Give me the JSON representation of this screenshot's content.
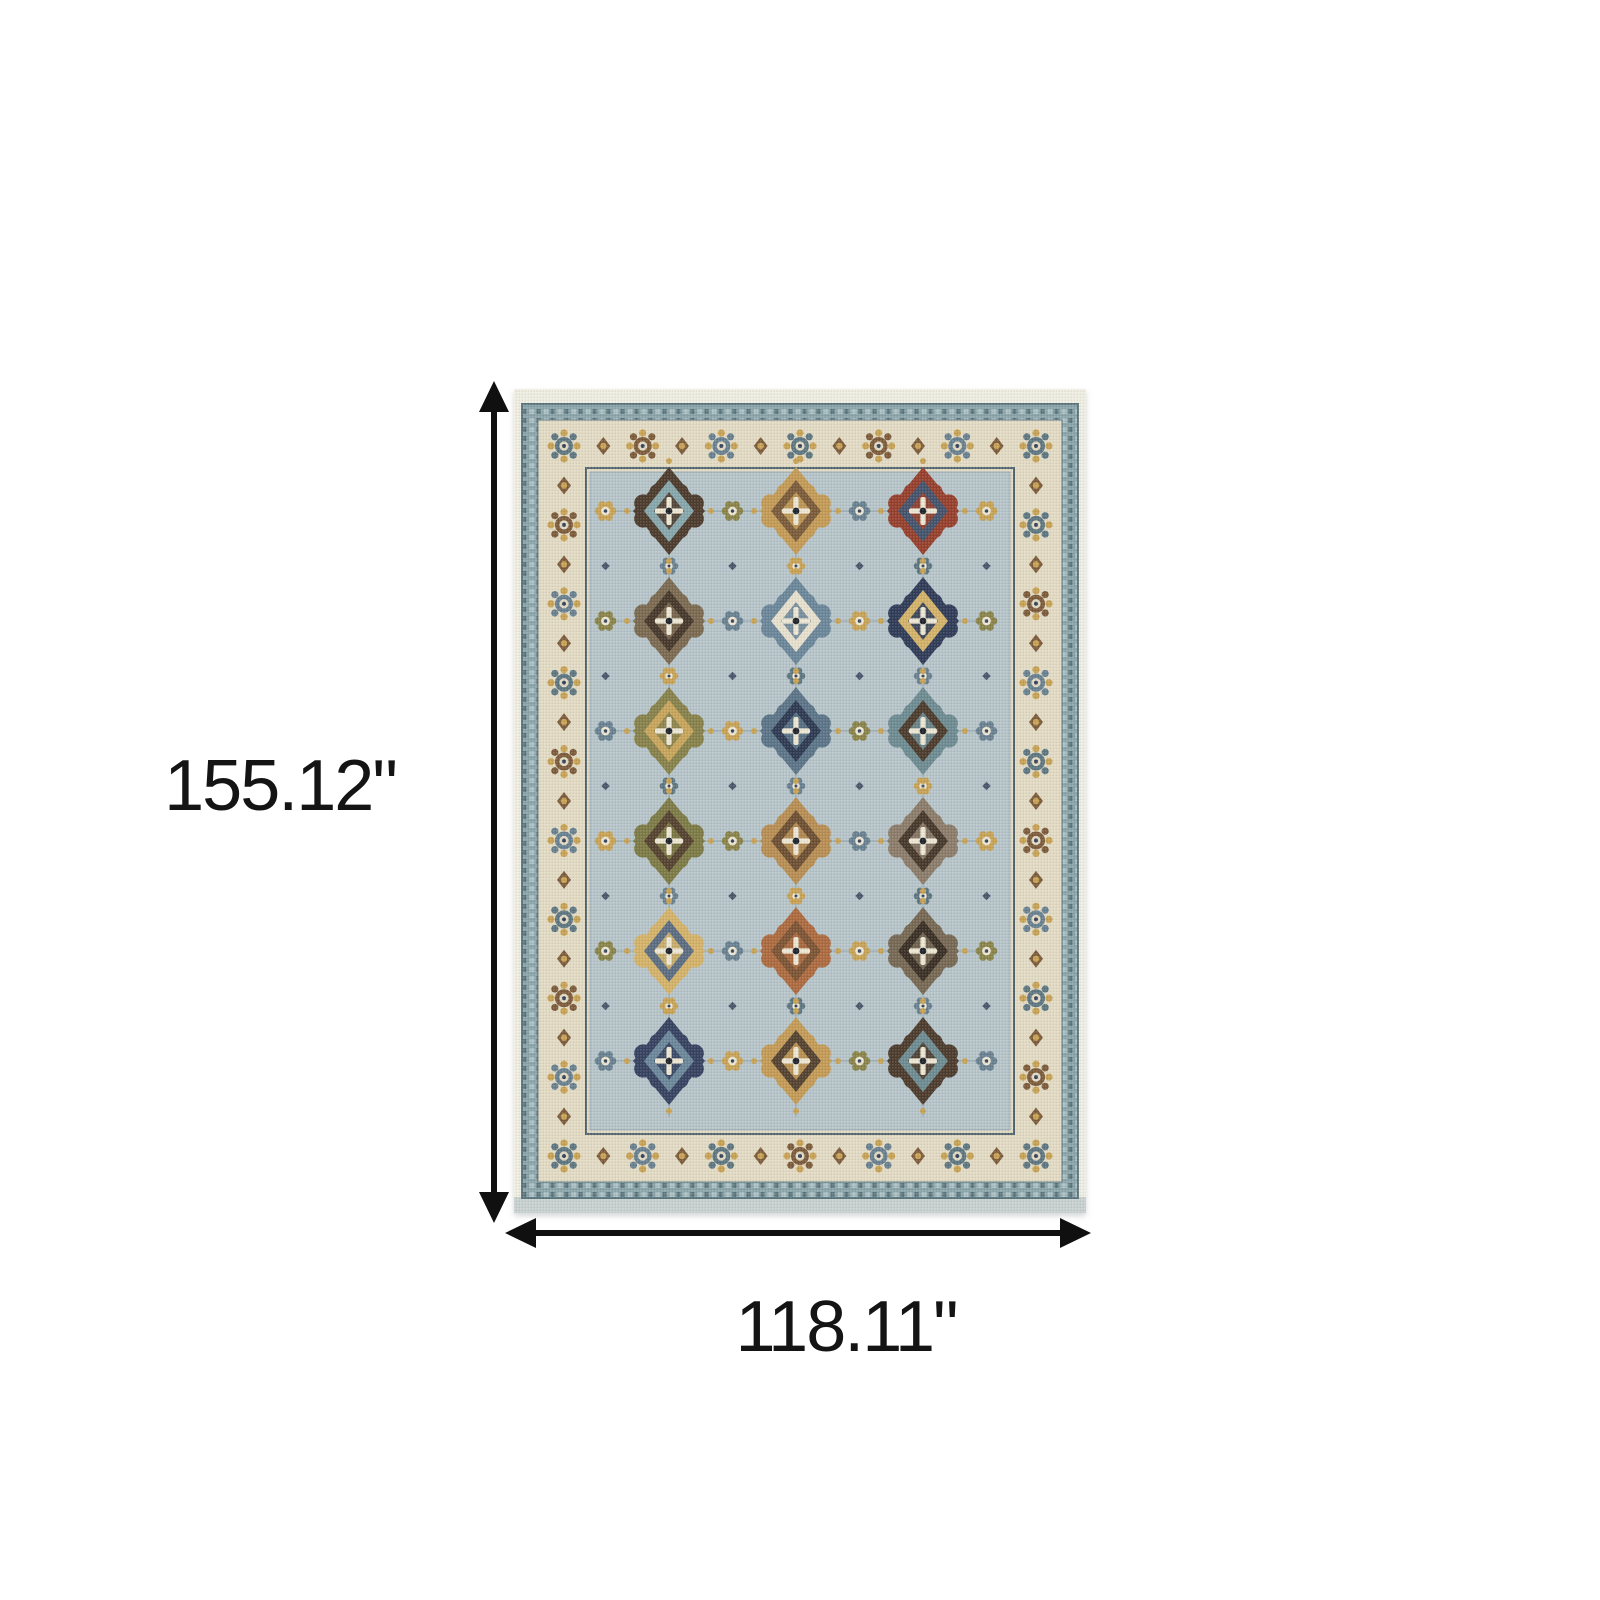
{
  "page": {
    "background": "#ffffff"
  },
  "dimensions": {
    "height": {
      "label": "155.12\"",
      "orientation": "vertical"
    },
    "width": {
      "label": "118.11\"",
      "orientation": "horizontal"
    },
    "arrow_color": "#101010",
    "text_color": "#141414"
  },
  "figure": {
    "name": "oriental-area-rug-with-dimensions",
    "rug": {
      "palette": {
        "fringe": "#efede1",
        "fringe_bottom": "#c8d1cf",
        "band": "#8aa4a9",
        "band_dark": "#5d777e",
        "band_light": "#aabfc2",
        "border": "#e2dac3",
        "field": "#b6c4c9",
        "guard": "#51646e",
        "vine": "#98abb1",
        "motifs": {
          "teal": "#5d7680",
          "slate": "#68808f",
          "gold": "#c8a254",
          "brown": "#7c5b3a",
          "navy": "#37435a",
          "olive": "#898348",
          "cream": "#ece5d2",
          "rust": "#94412e"
        }
      },
      "field_medallions": [
        [
          [
            "#4c3b2c",
            "#86a6ab"
          ],
          [
            "#c39a55",
            "#7a5b39"
          ],
          [
            "#963f2c",
            "#44536b"
          ]
        ],
        [
          [
            "#7b6950",
            "#46382a"
          ],
          [
            "#6b8699",
            "#e6dfcc"
          ],
          [
            "#2f3b57",
            "#d3b268"
          ]
        ],
        [
          [
            "#87814a",
            "#c7a45a"
          ],
          [
            "#5b7487",
            "#2e3a52"
          ],
          [
            "#6d8b91",
            "#4c3b2c"
          ]
        ],
        [
          [
            "#7d7a45",
            "#55422f"
          ],
          [
            "#b78d52",
            "#6d4f32"
          ],
          [
            "#8b7b69",
            "#46382a"
          ]
        ],
        [
          [
            "#d3b268",
            "#5c6c81"
          ],
          [
            "#ad6a3f",
            "#7c5434"
          ],
          [
            "#766752",
            "#3a2f25"
          ]
        ],
        [
          [
            "#364260",
            "#6b8699"
          ],
          [
            "#c39a55",
            "#55422f"
          ],
          [
            "#4c3b2c",
            "#6d8b91"
          ]
        ]
      ]
    }
  }
}
